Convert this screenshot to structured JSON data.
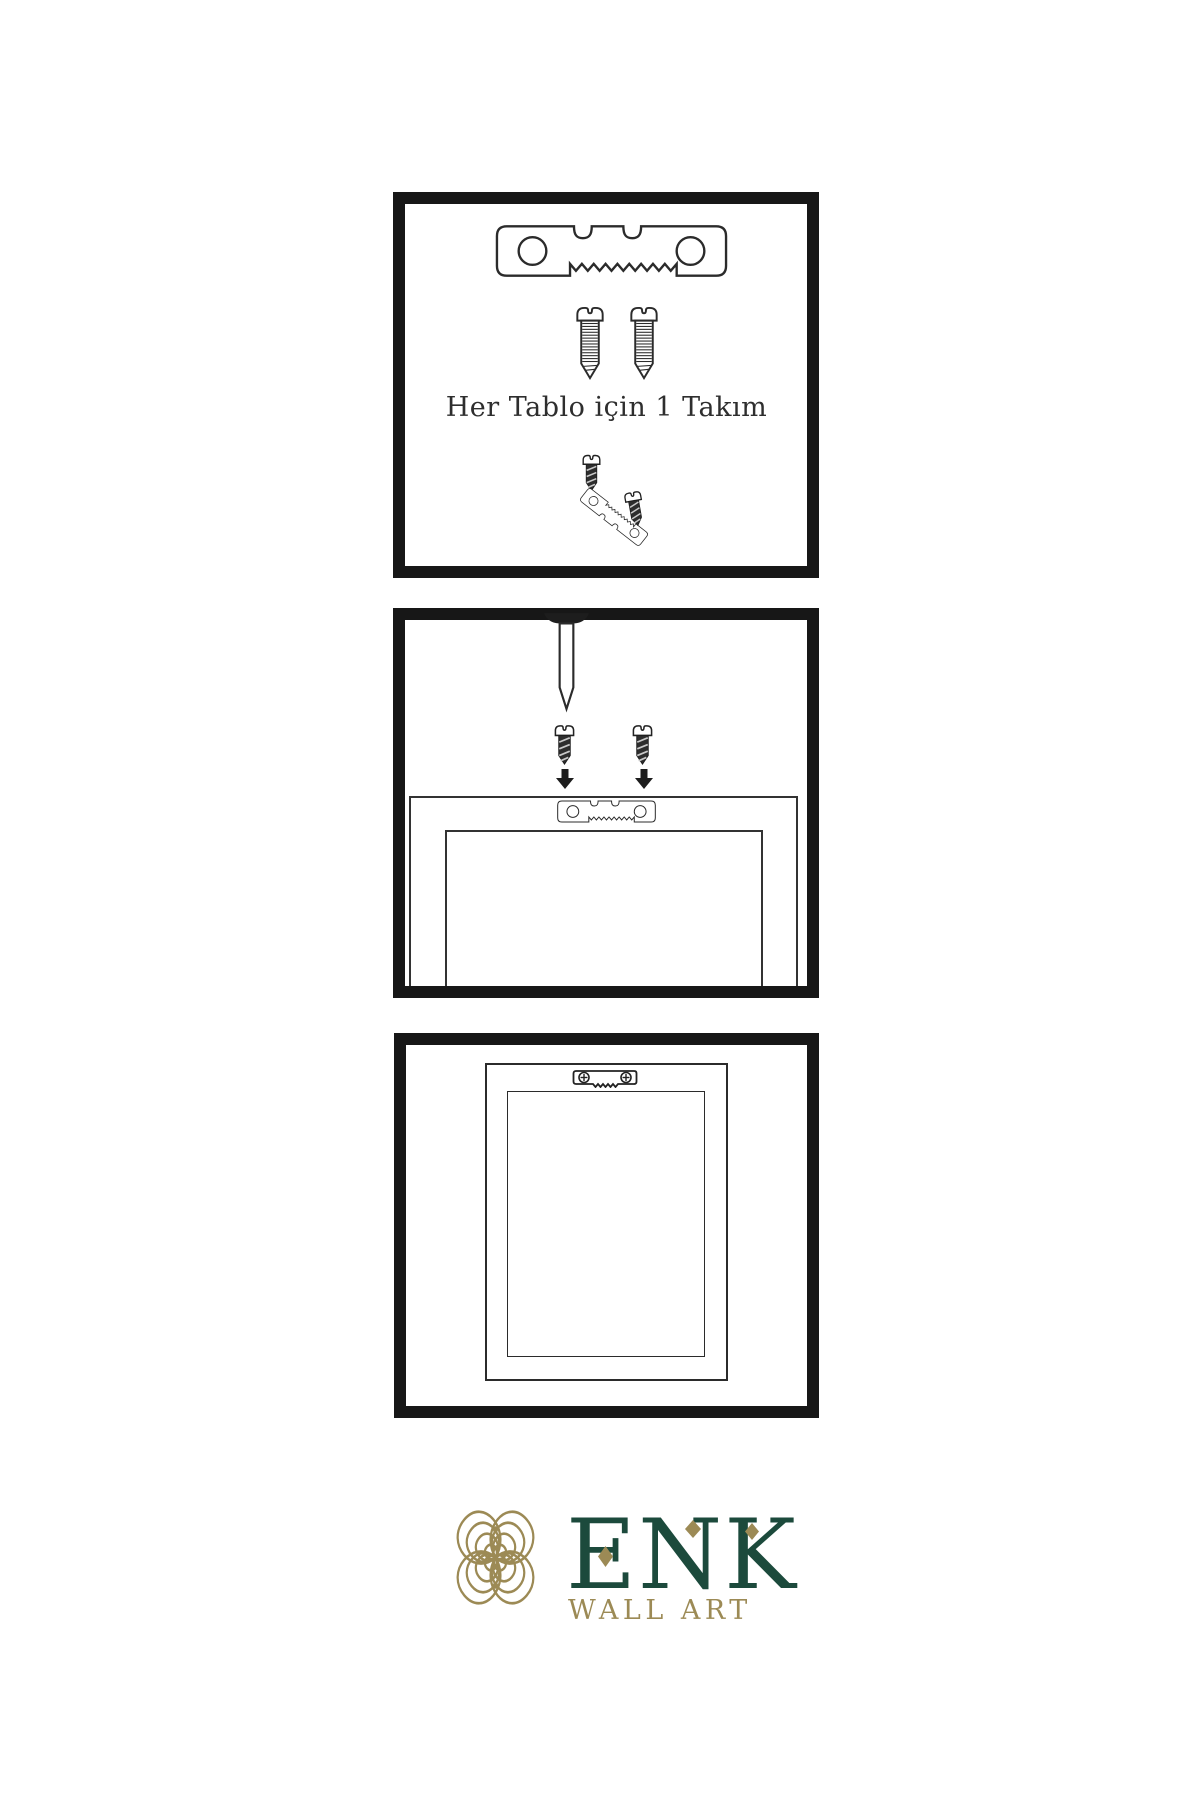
{
  "colors": {
    "background": "#ffffff",
    "line": "#2b2b2b",
    "panel_border": "#171717",
    "brand_green": "#1c4a3c",
    "brand_gold": "#9c8a55"
  },
  "steps": {
    "step1": {
      "caption": "Her Tablo için 1 Takım"
    },
    "step2": {
      "caption": ""
    },
    "step3": {
      "caption": ""
    }
  },
  "brand": {
    "name": "ENK",
    "tagline": "WALL ART"
  },
  "icons": {
    "hardware": [
      "sawtooth-hanger-icon",
      "screw-icon",
      "dark-screw-icon",
      "wall-nail-icon",
      "down-arrow-icon",
      "phillips-hanger-icon",
      "tilted-sawtooth-hanger-icon"
    ],
    "brand": [
      "knot-logo-icon",
      "diamond-icon"
    ]
  }
}
